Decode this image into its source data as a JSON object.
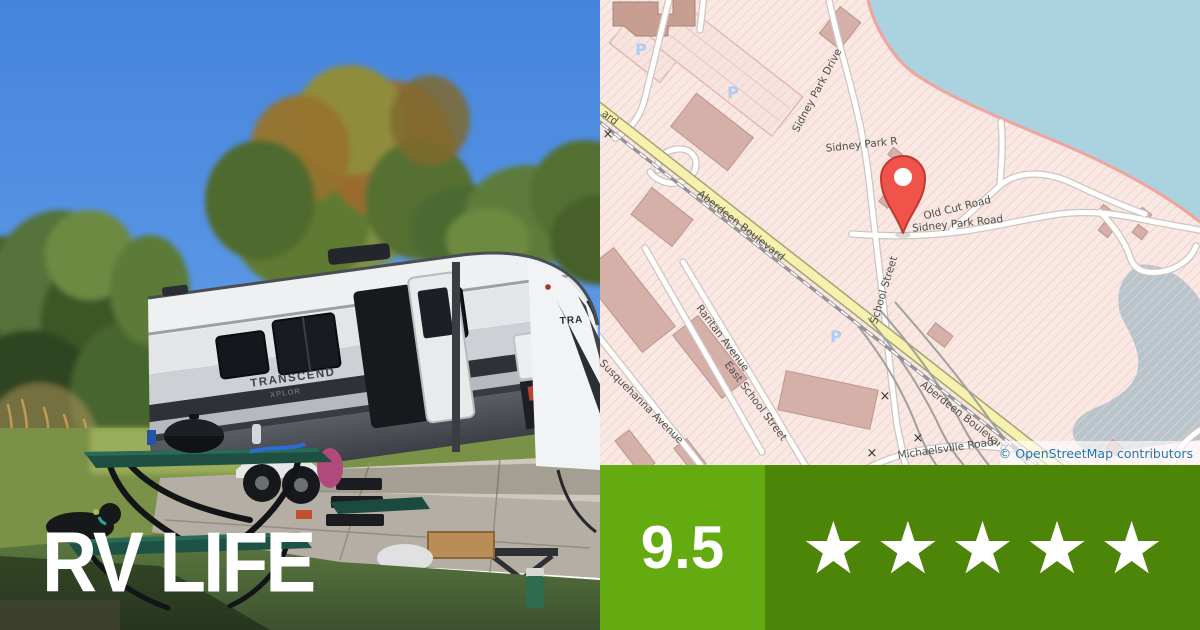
{
  "title_overlay": "RV LIFE",
  "photo": {
    "rv_decal_primary": "TRANSCEND",
    "rv_decal_secondary": "XPLOR",
    "rv_front_decal_fragment": "TRA"
  },
  "rating": {
    "score": "9.5",
    "stars_count": 5,
    "stars_display": "★★★★★",
    "score_bg": "#64ab11",
    "stars_bg": "#4d8508"
  },
  "map": {
    "attribution": "© OpenStreetMap contributors",
    "parking_symbol": "P",
    "crossing_symbol": "×",
    "colors": {
      "land": "#f9e8e3",
      "hatch_line": "#f2cfc7",
      "water": "#aad3df",
      "river": "#b6c5cd",
      "coastline": "#f2a39b",
      "road_fill": "#ffffff",
      "road_casing": "#cfc5c0",
      "primary_road_fill": "#f6f1ae",
      "primary_road_casing": "#a3a370",
      "building": "#d5b0a8",
      "building_outline": "#bc958d",
      "rail": "#949494",
      "label_text": "#4e4e4e",
      "parking_blue": "#aecdf2",
      "pin_red": "#ef5349",
      "attribution_text": "#2577b5"
    },
    "labels": [
      {
        "text": "Sidney Park Drive"
      },
      {
        "text": "Sidney Park R"
      },
      {
        "text": "Old Cut Road"
      },
      {
        "text": "Sidney Park Road"
      },
      {
        "text": "School Street"
      },
      {
        "text": "Aberdeen Boulevard"
      },
      {
        "text": "Aberdeen Boulevard"
      },
      {
        "text": "ard"
      },
      {
        "text": "Raritan Avenue"
      },
      {
        "text": "East School Street"
      },
      {
        "text": "Susquehanna Avenue"
      },
      {
        "text": "Michaelsville Road"
      }
    ]
  }
}
